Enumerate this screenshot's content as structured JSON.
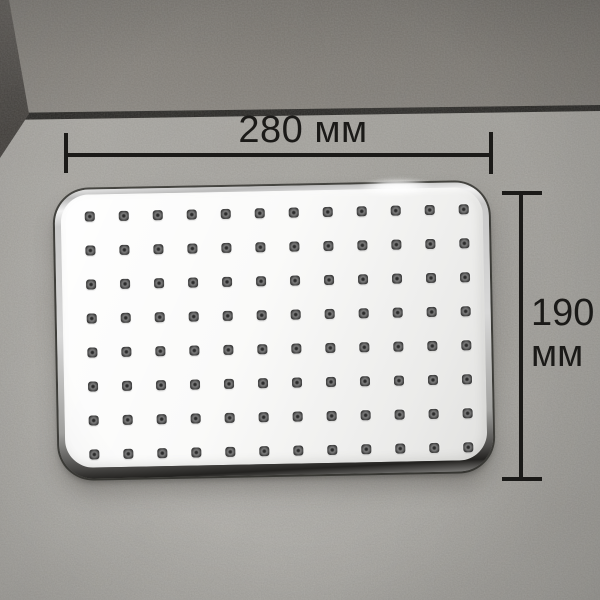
{
  "annotations": {
    "width_label": "280 мм",
    "height_value": "190",
    "height_unit": "мм"
  },
  "product": {
    "type": "rectangular overhead rain shower head",
    "nozzle_grid": {
      "rows": 8,
      "cols": 12
    }
  },
  "colors": {
    "dim": "#1b1a18",
    "wall": "#827e78",
    "left_wall": "#4b4743",
    "junction": "#201f1d",
    "floor": "#a9a7a2",
    "face": "#fafaf9",
    "chrome_dark": "#2a2927",
    "nozzle": "#4b4b4b"
  }
}
